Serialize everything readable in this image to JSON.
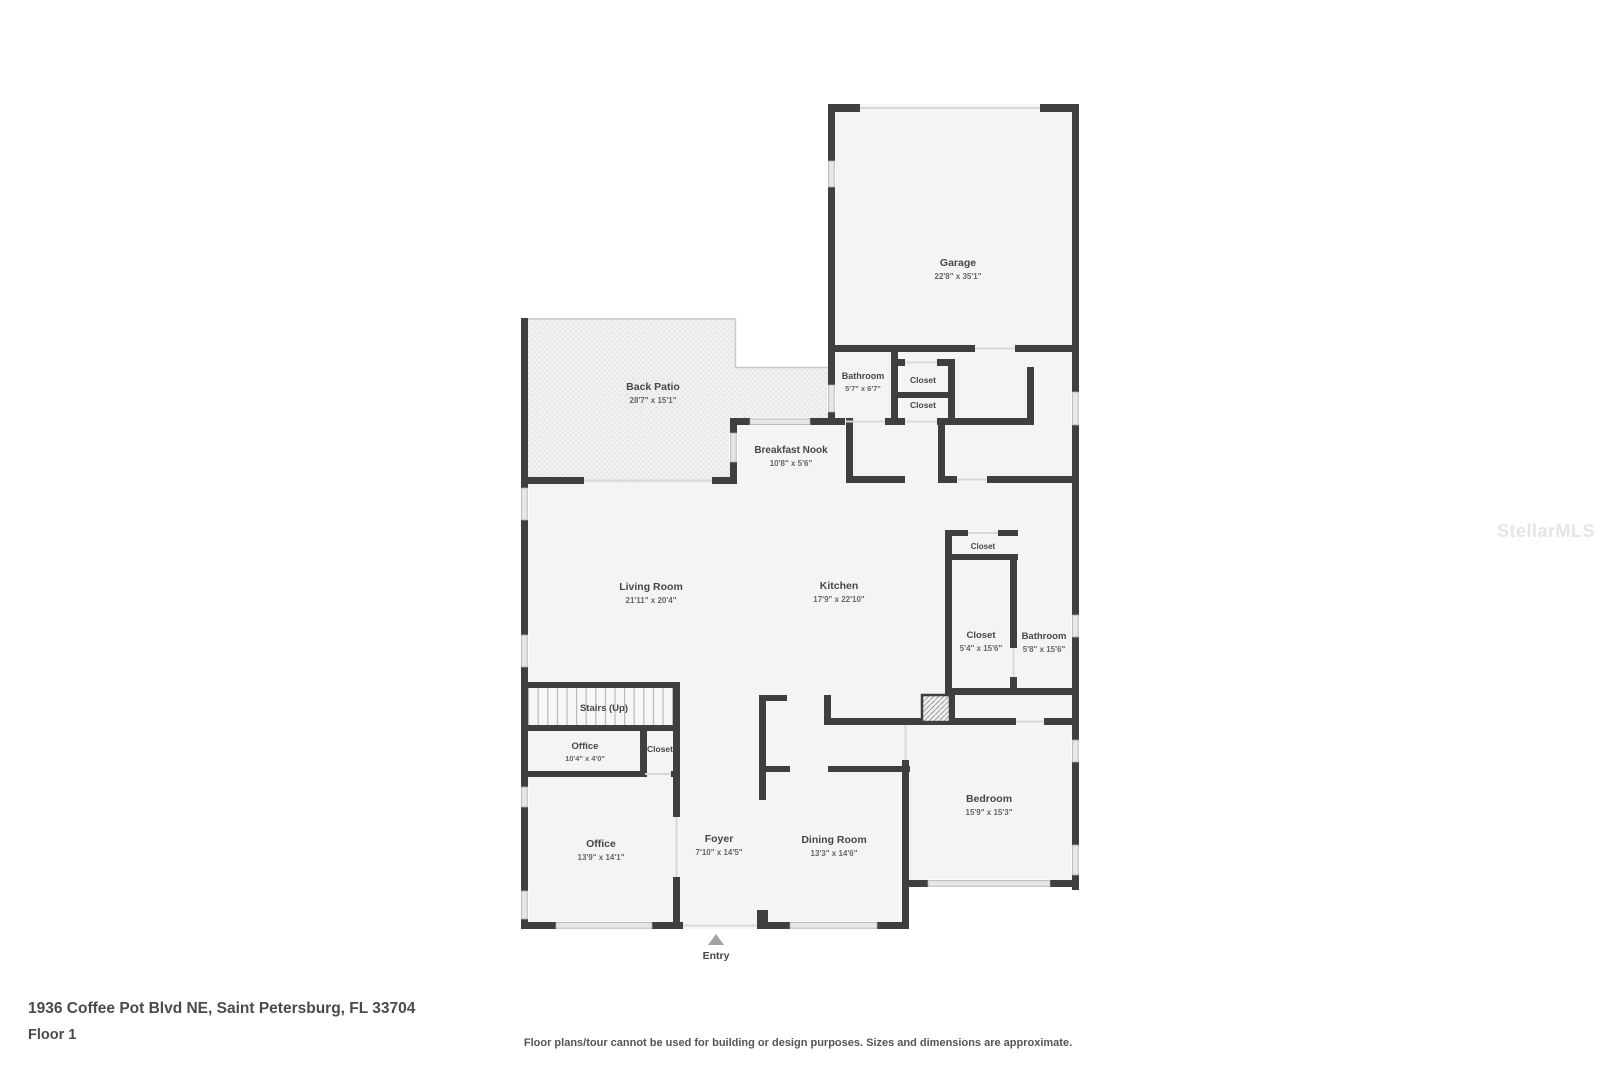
{
  "floorplan": {
    "rooms": [
      {
        "name": "Garage",
        "dims": "22'8\" x 35'1\""
      },
      {
        "name": "Back Patio",
        "dims": "28'7\" x 15'1\""
      },
      {
        "name": "Bathroom",
        "dims": "5'7\" x 6'7\""
      },
      {
        "name": "Closet",
        "dims": ""
      },
      {
        "name": "Closet",
        "dims": ""
      },
      {
        "name": "Breakfast Nook",
        "dims": "10'8\" x 5'6\""
      },
      {
        "name": "Living Room",
        "dims": "21'11\" x 20'4\""
      },
      {
        "name": "Kitchen",
        "dims": "17'9\" x 22'10\""
      },
      {
        "name": "Closet",
        "dims": ""
      },
      {
        "name": "Closet",
        "dims": "5'4\" x 15'6\""
      },
      {
        "name": "Bathroom",
        "dims": "5'8\" x 15'6\""
      },
      {
        "name": "Stairs (Up)",
        "dims": ""
      },
      {
        "name": "Office",
        "dims": "10'4\" x 4'0\""
      },
      {
        "name": "Closet",
        "dims": ""
      },
      {
        "name": "Office",
        "dims": "13'9\" x 14'1\""
      },
      {
        "name": "Foyer",
        "dims": "7'10\" x 14'5\""
      },
      {
        "name": "Dining Room",
        "dims": "13'3\" x 14'6\""
      },
      {
        "name": "Bedroom",
        "dims": "15'9\" x 15'3\""
      }
    ],
    "entry_label": "Entry",
    "watermark": "StellarMLS",
    "colors": {
      "wall": "#3f3f3f",
      "room_fill": "#f4f4f4",
      "label": "#474747",
      "watermark": "#e5e5e5"
    }
  },
  "footer": {
    "address": "1936 Coffee Pot Blvd NE, Saint Petersburg, FL 33704",
    "floor_label": "Floor 1",
    "disclaimer": "Floor plans/tour cannot be used for building or design purposes. Sizes and dimensions are approximate."
  }
}
